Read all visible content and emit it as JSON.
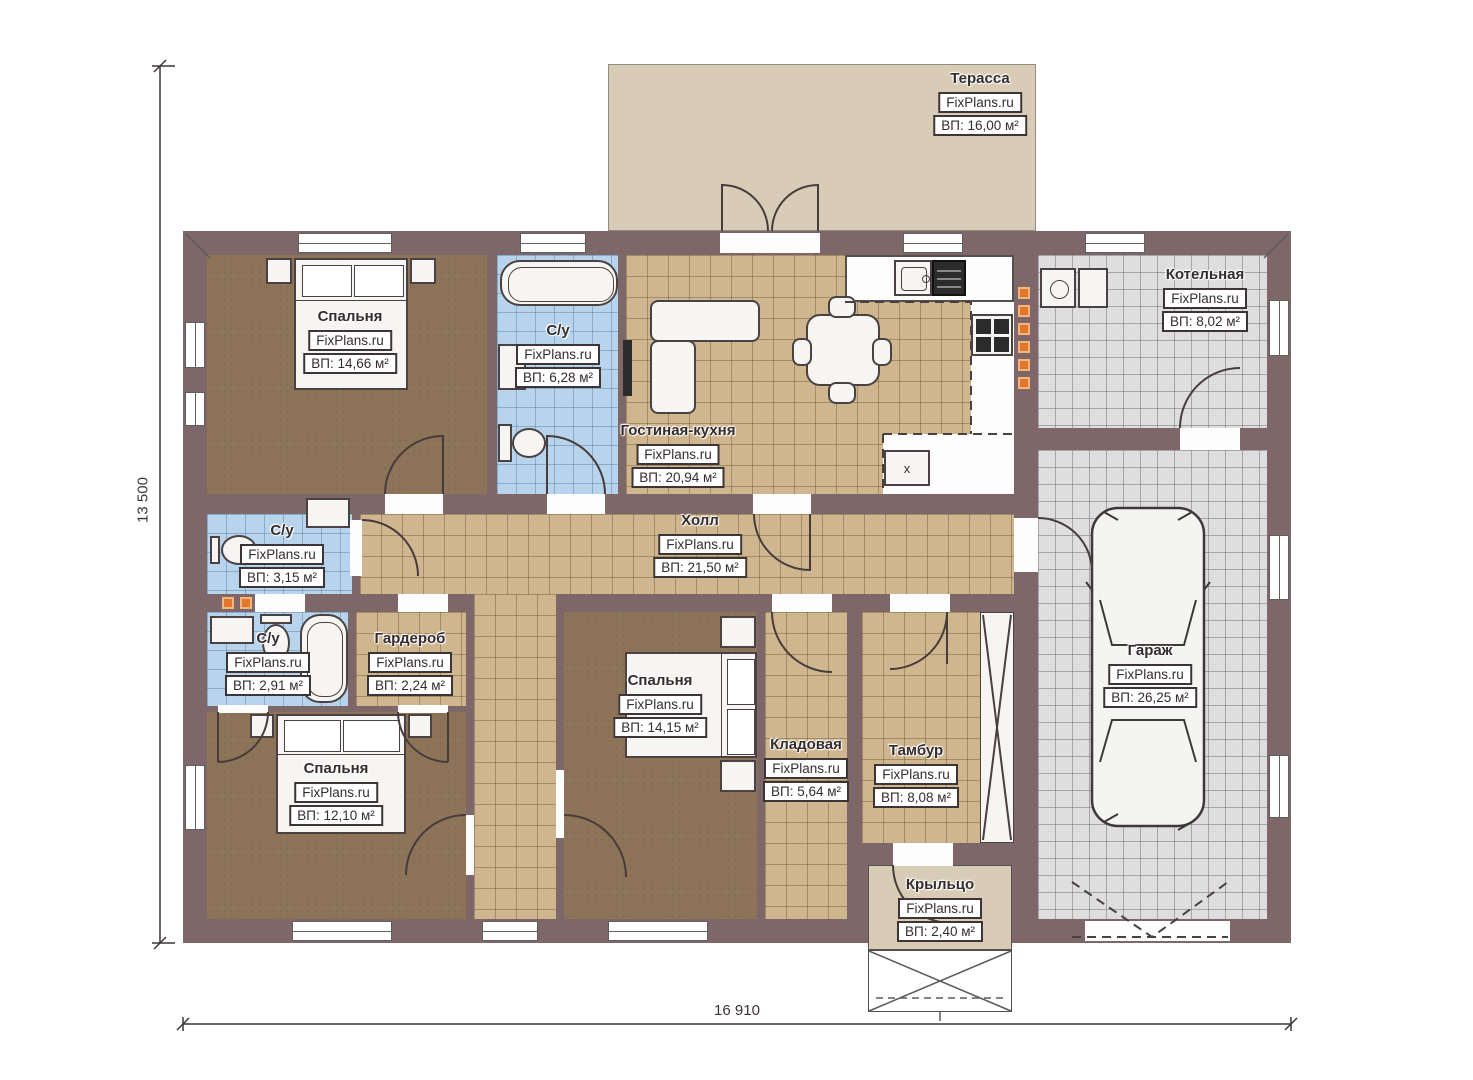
{
  "watermark": "FixPlans.ru",
  "dimensions": {
    "height_label": "13 500",
    "width_label": "16 910"
  },
  "living_unit_label": "x",
  "colors": {
    "wall": "#7d6768",
    "floor_wood": "#8d7459",
    "floor_tile_tan": "#cfb68e",
    "floor_tile_blue": "#b7d4ec",
    "floor_tile_gray": "#dedede",
    "terrace": "#d8ccb6",
    "accent_orange": "#e2762b",
    "line": "#3d3535"
  },
  "rooms": [
    {
      "id": "terrace",
      "name": "Терасса",
      "area": "ВП: 16,00 м²"
    },
    {
      "id": "bedroom-1",
      "name": "Спальня",
      "area": "ВП: 14,66 м²"
    },
    {
      "id": "bath-1",
      "name": "С/у",
      "area": "ВП: 6,28 м²"
    },
    {
      "id": "living",
      "name": "Гостиная-кухня",
      "area": "ВП: 20,94 м²"
    },
    {
      "id": "boiler",
      "name": "Котельная",
      "area": "ВП: 8,02 м²"
    },
    {
      "id": "hall",
      "name": "Холл",
      "area": "ВП: 21,50 м²"
    },
    {
      "id": "bath-2",
      "name": "С/у",
      "area": "ВП: 3,15 м²"
    },
    {
      "id": "bath-3",
      "name": "С/у",
      "area": "ВП: 2,91 м²"
    },
    {
      "id": "wardrobe",
      "name": "Гардероб",
      "area": "ВП: 2,24 м²"
    },
    {
      "id": "bedroom-2",
      "name": "Спальня",
      "area": "ВП: 14,15 м²"
    },
    {
      "id": "storage",
      "name": "Кладовая",
      "area": "ВП: 5,64 м²"
    },
    {
      "id": "vestibule",
      "name": "Тамбур",
      "area": "ВП: 8,08 м²"
    },
    {
      "id": "garage",
      "name": "Гараж",
      "area": "ВП: 26,25 м²"
    },
    {
      "id": "bedroom-3",
      "name": "Спальня",
      "area": "ВП: 12,10 м²"
    },
    {
      "id": "porch",
      "name": "Крыльцо",
      "area": "ВП: 2,40 м²"
    }
  ]
}
